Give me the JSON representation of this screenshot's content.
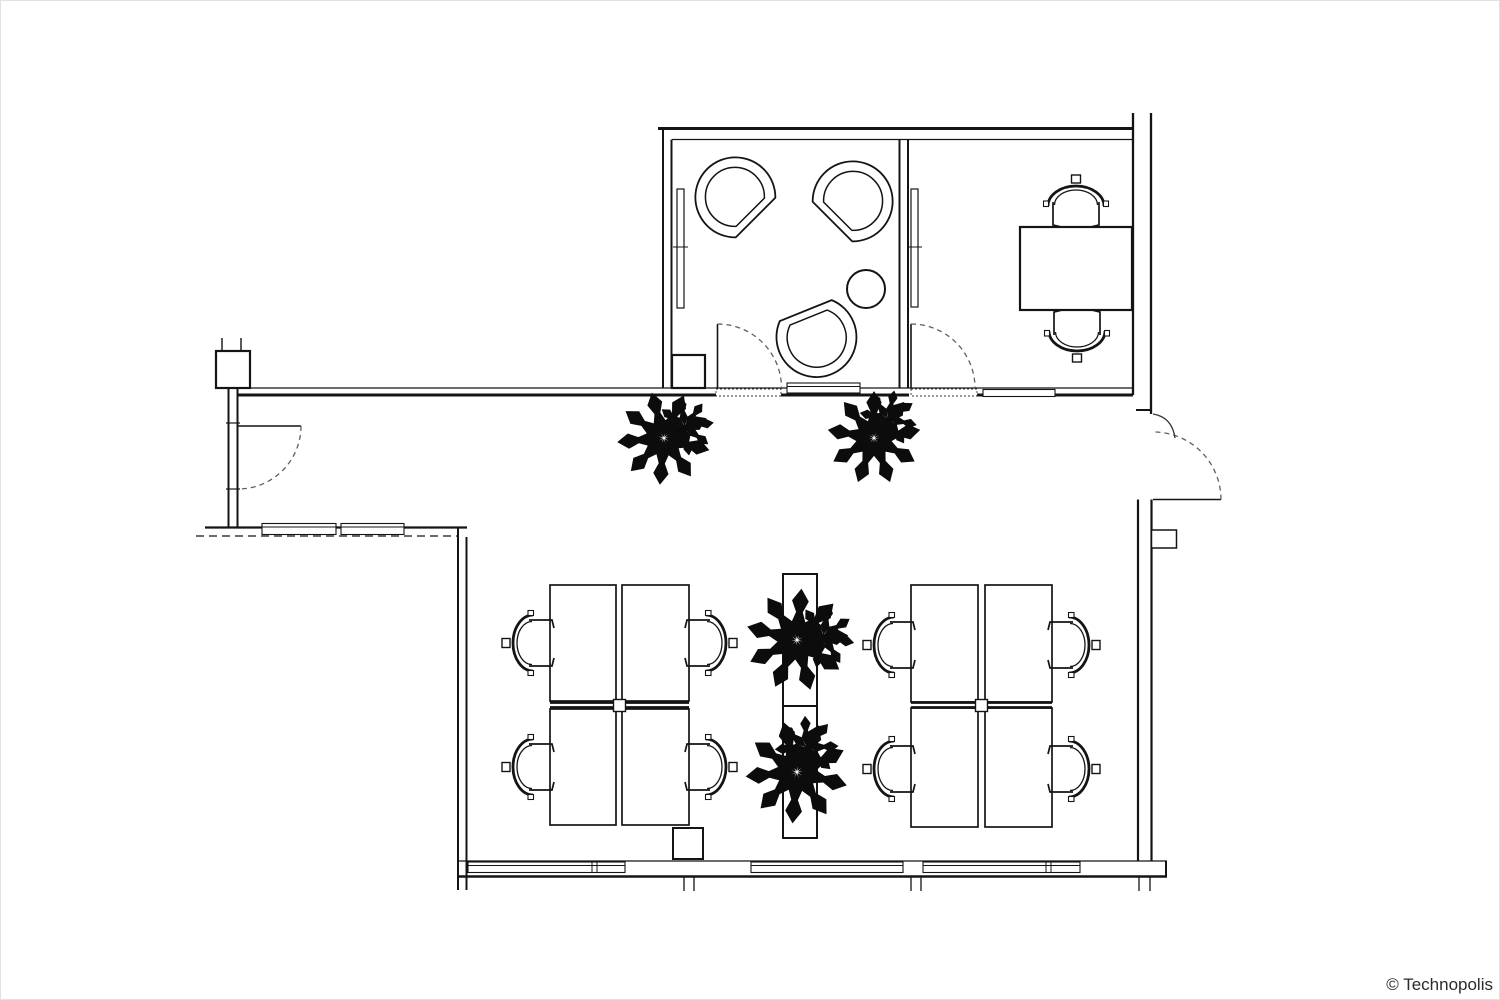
{
  "footer": {
    "copyright": "© Technopolis"
  },
  "palette": {
    "background": "#ffffff",
    "line_color": "#141414",
    "door_arc_color": "#5f5f5f",
    "plant_color": "#0c0c0c",
    "text_color": "#2b2b2b"
  },
  "plan": {
    "kind": "office-floor-plan",
    "rooms": [
      {
        "id": "lounge-room",
        "contents": [
          "3 lounge chairs",
          "round side table",
          "wall panel",
          "door"
        ]
      },
      {
        "id": "private-office",
        "contents": [
          "desk",
          "2 task chairs",
          "wall panel",
          "door"
        ]
      },
      {
        "id": "open-office",
        "contents": [
          "two 2x2 desk clusters (8 desks)",
          "8 task chairs",
          "planter box with 2 plants",
          "pedestal cabinet"
        ]
      },
      {
        "id": "corridor",
        "contents": [
          "2 plants",
          "entrance door",
          "side exit door"
        ]
      }
    ],
    "counts": {
      "desks": 9,
      "task_chairs": 10,
      "lounge_chairs": 3,
      "plants": 4,
      "doors": 4,
      "window_segments": 7
    }
  }
}
